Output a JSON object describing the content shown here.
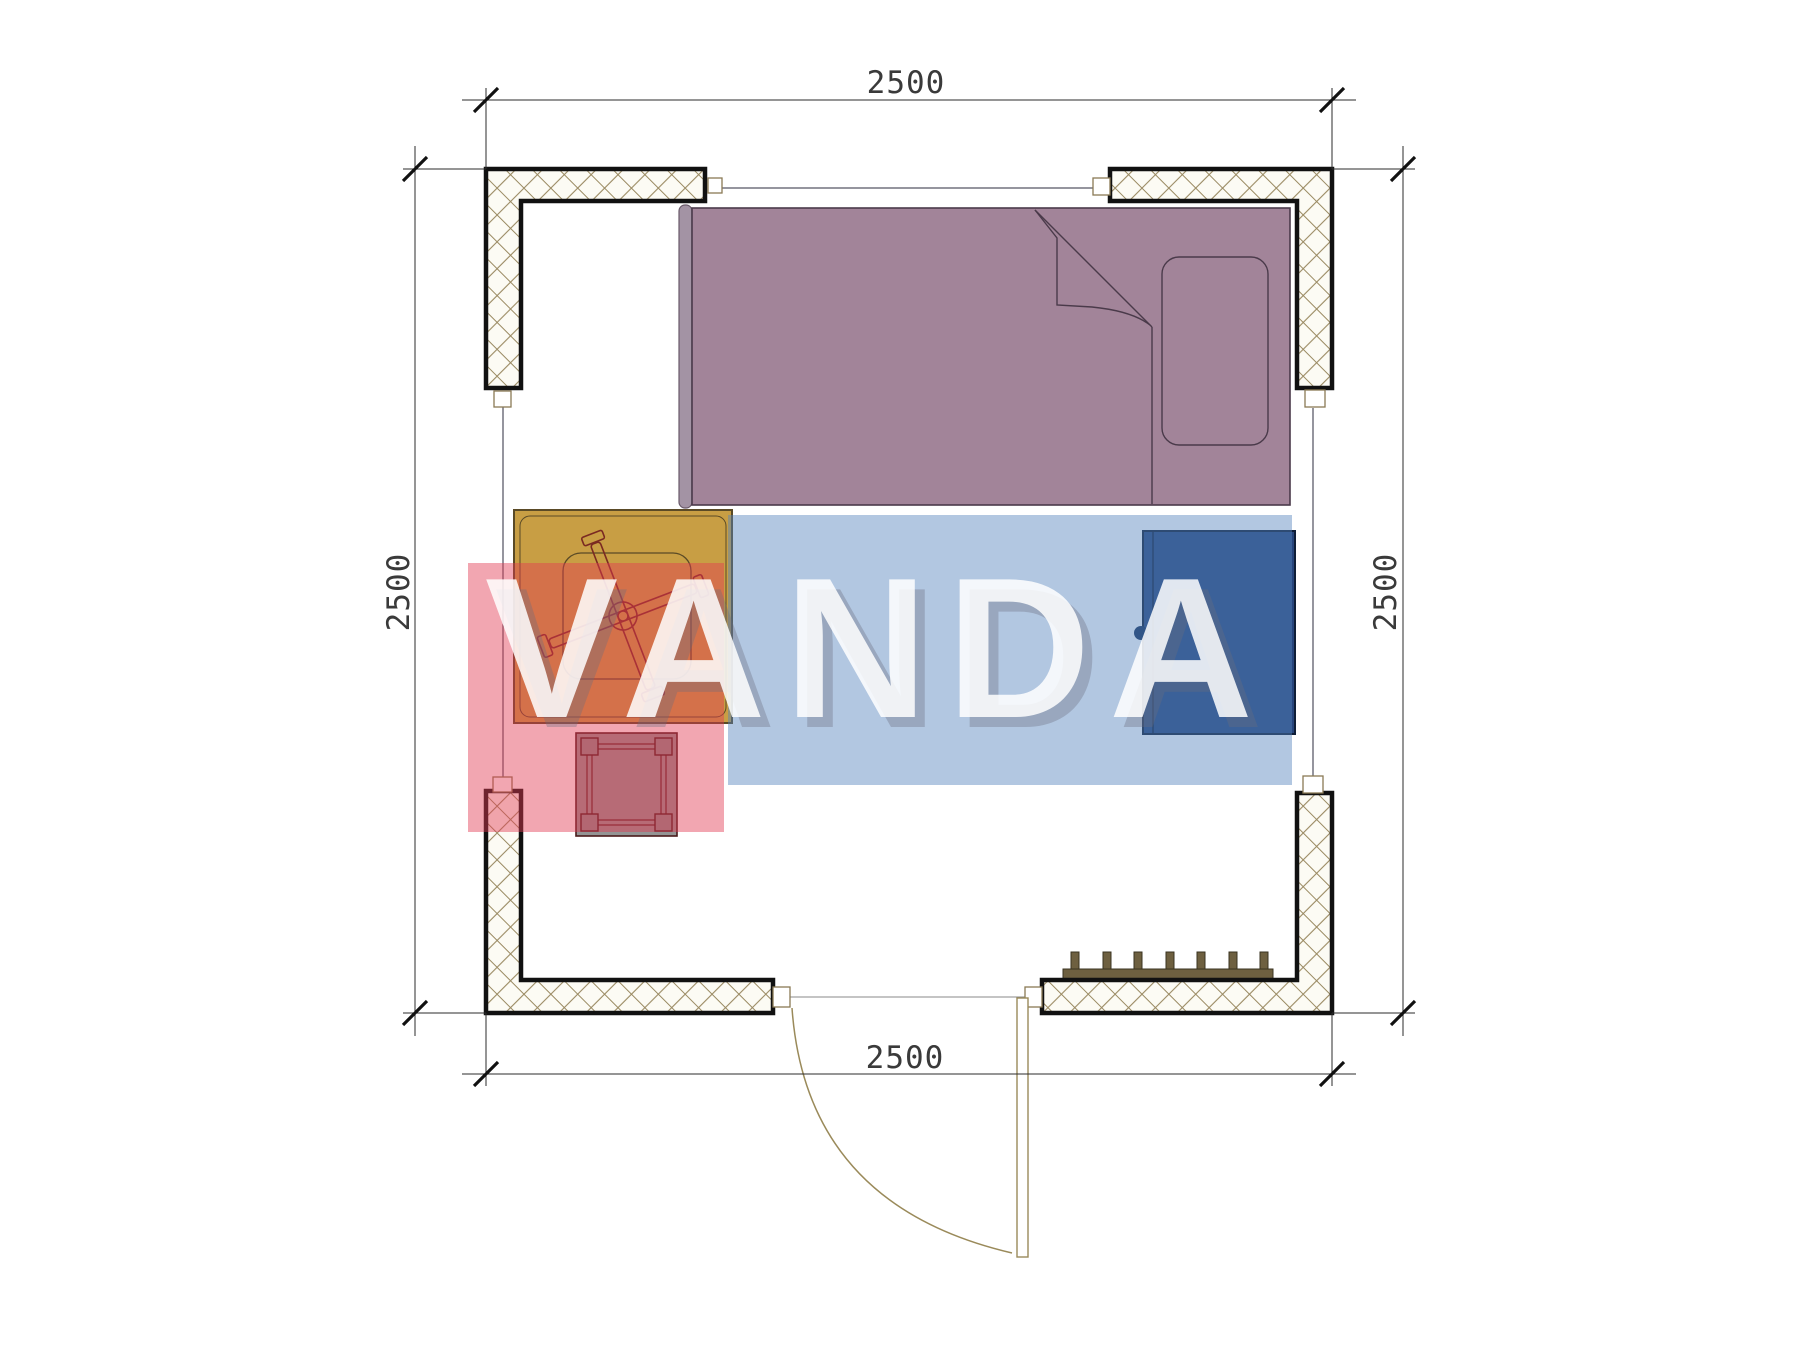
{
  "watermark": {
    "text": "VANDA",
    "red_block_color": "rgba(226,58,82,0.45)",
    "blue_block_color": "rgba(84,130,189,0.45)",
    "text_color": "rgba(255,255,255,0.85)"
  },
  "dimensions": {
    "top": "2500",
    "bottom": "2500",
    "left": "2500",
    "right": "2500"
  },
  "plan": {
    "objects": [
      "bed",
      "pillow",
      "table",
      "office-chair",
      "stool",
      "wardrobe",
      "radiator",
      "door"
    ],
    "radiator_sections": 7,
    "colors": {
      "wall_fill": "#fcfbf4",
      "wall_hatch_line": "#9a8a62",
      "wall_outline": "#111111",
      "bed": "#a28499",
      "bed_headboard": "#a393a4",
      "bed_outline": "#4a3a4a",
      "table": "#c89e44",
      "table_outline": "#5a4a26",
      "chair_line": "#7a2a22",
      "stool": "#949494",
      "stool_outline": "#5a1f1f",
      "cabinet": "#27457c",
      "cabinet_outline": "#0f1e38",
      "radiator": "#6e6040",
      "door_line": "#9a8a5a"
    }
  }
}
